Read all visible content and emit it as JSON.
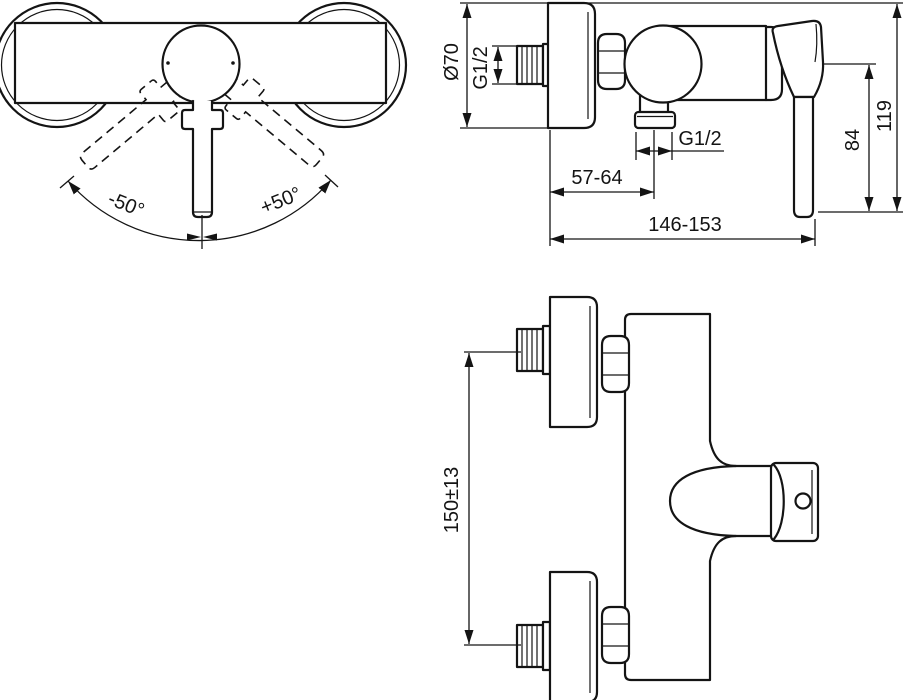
{
  "document": {
    "kind": "technical installation drawing",
    "subject": "wall-mounted single-lever shower mixer, three orthographic views",
    "colors": {
      "line": "#141414",
      "background": "#ffffff"
    }
  },
  "views": {
    "front": {
      "labels": {
        "swing_left": "-50°",
        "swing_right": "+50°"
      }
    },
    "side": {
      "labels": {
        "rosette_diameter": "Ø70",
        "inlet_thread": "G1/2",
        "outlet_thread": "G1/2",
        "wall_to_outlet": "57-64",
        "total_depth": "146-153",
        "lever_drop": "84",
        "total_height": "119"
      }
    },
    "plan": {
      "labels": {
        "inlet_spacing": "150±13"
      }
    }
  }
}
